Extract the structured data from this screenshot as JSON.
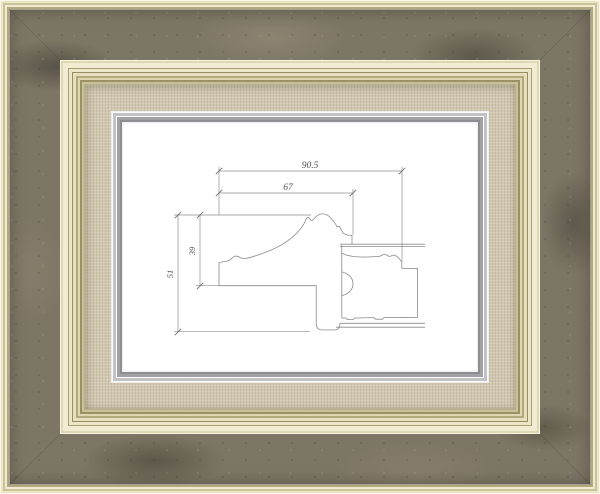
{
  "frame": {
    "description_label": "",
    "colors": {
      "outer_edge_cream": "#ece7c9",
      "marble_band": "#7c7665",
      "molding_gold": "#a89e72",
      "linen_liner": "#d1c7af",
      "silver_lip": "#bcbcbe",
      "mat_white": "#ffffff"
    }
  },
  "drawing": {
    "dimensions": {
      "total_width": "90.5",
      "face_width": "67",
      "total_height": "51",
      "face_height": "39"
    }
  }
}
